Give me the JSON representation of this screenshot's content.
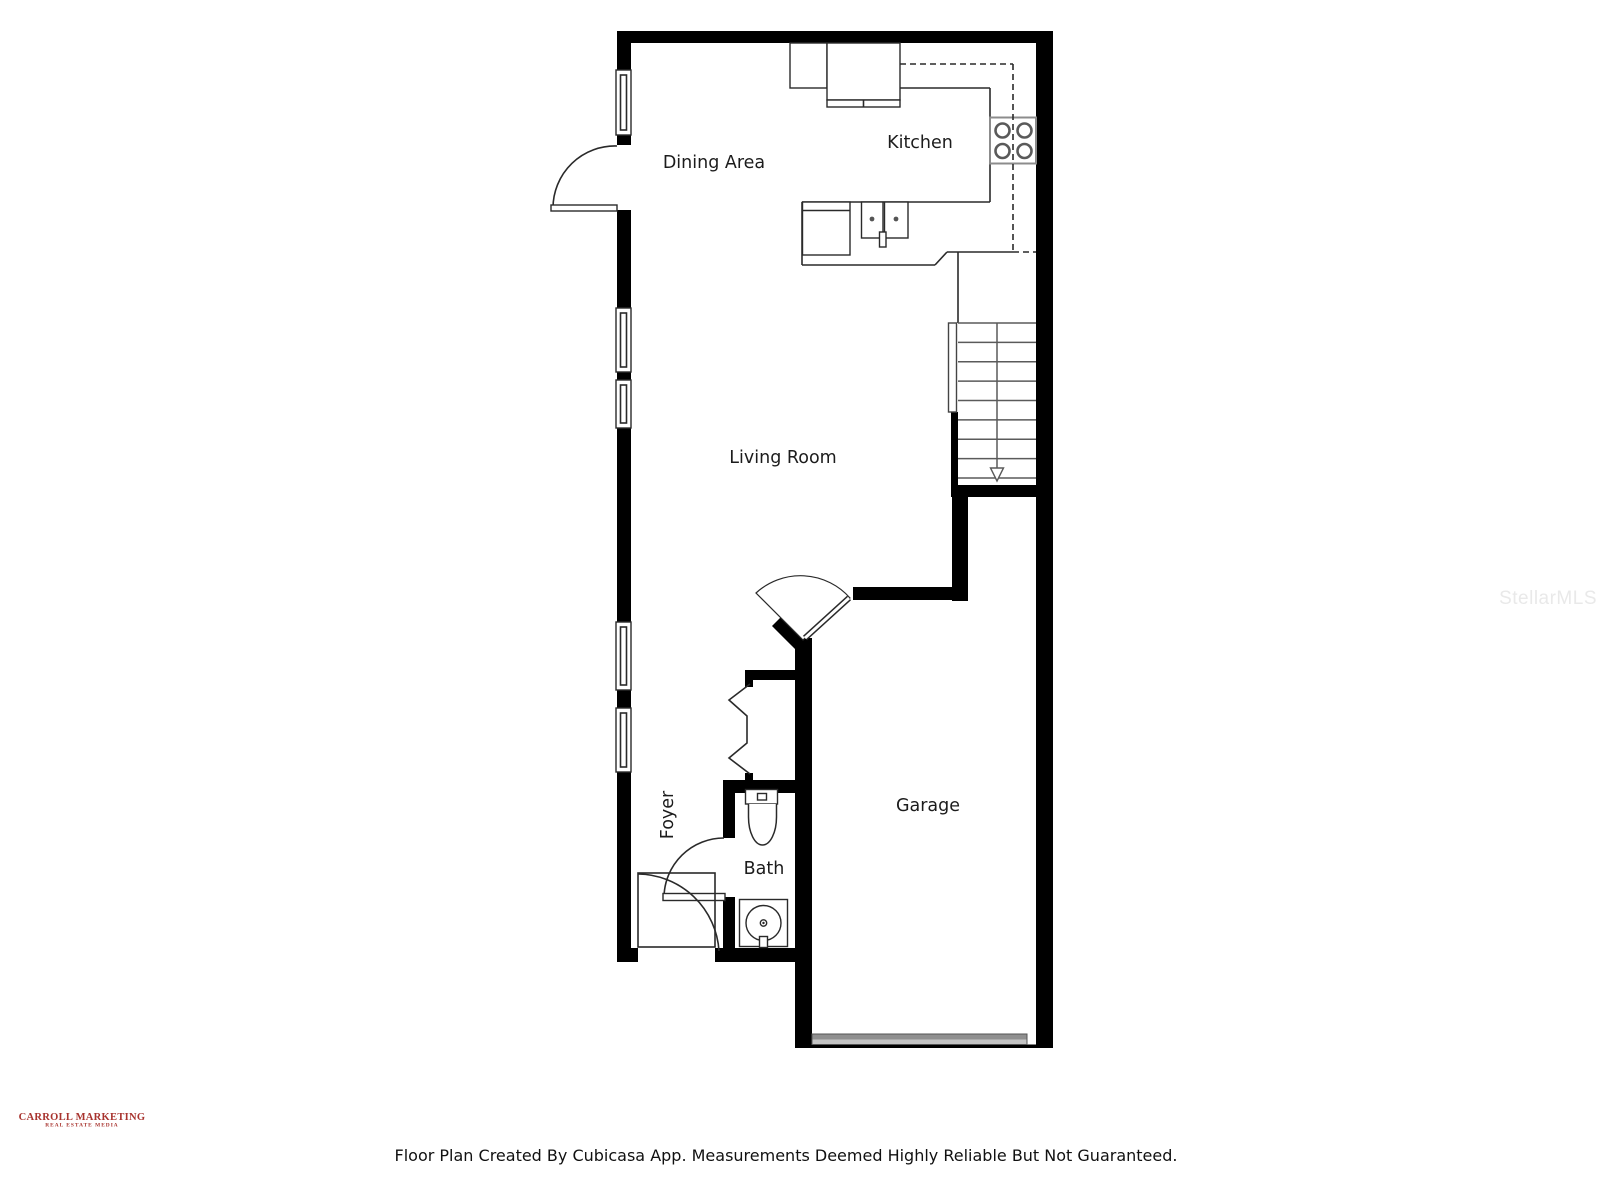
{
  "floor_plan": {
    "rooms": {
      "dining_area": "Dining Area",
      "kitchen": "Kitchen",
      "living_room": "Living Room",
      "foyer": "Foyer",
      "bath": "Bath",
      "garage": "Garage"
    },
    "caption": "Floor Plan Created By Cubicasa App. Measurements Deemed Highly Reliable But Not Guaranteed.",
    "watermark": "StellarMLS",
    "logo": {
      "line1": "CARROLL MARKETING",
      "line2": "REAL ESTATE MEDIA",
      "color": "#a8332e"
    },
    "colors": {
      "wall": "#000000",
      "line": "#2a2a2a",
      "fixture_gray": "#8c8c8c",
      "garage_door_dark": "#8f8f8f",
      "garage_door_light": "#c4c4c4",
      "watermark_gray": "#e9e9e9"
    },
    "fixtures": [
      "stove-icon",
      "kitchen-sink-icon",
      "toilet-icon",
      "bath-sink-icon",
      "stairs",
      "garage-door",
      "closet-bifold-door",
      "windows",
      "door-swings"
    ]
  }
}
